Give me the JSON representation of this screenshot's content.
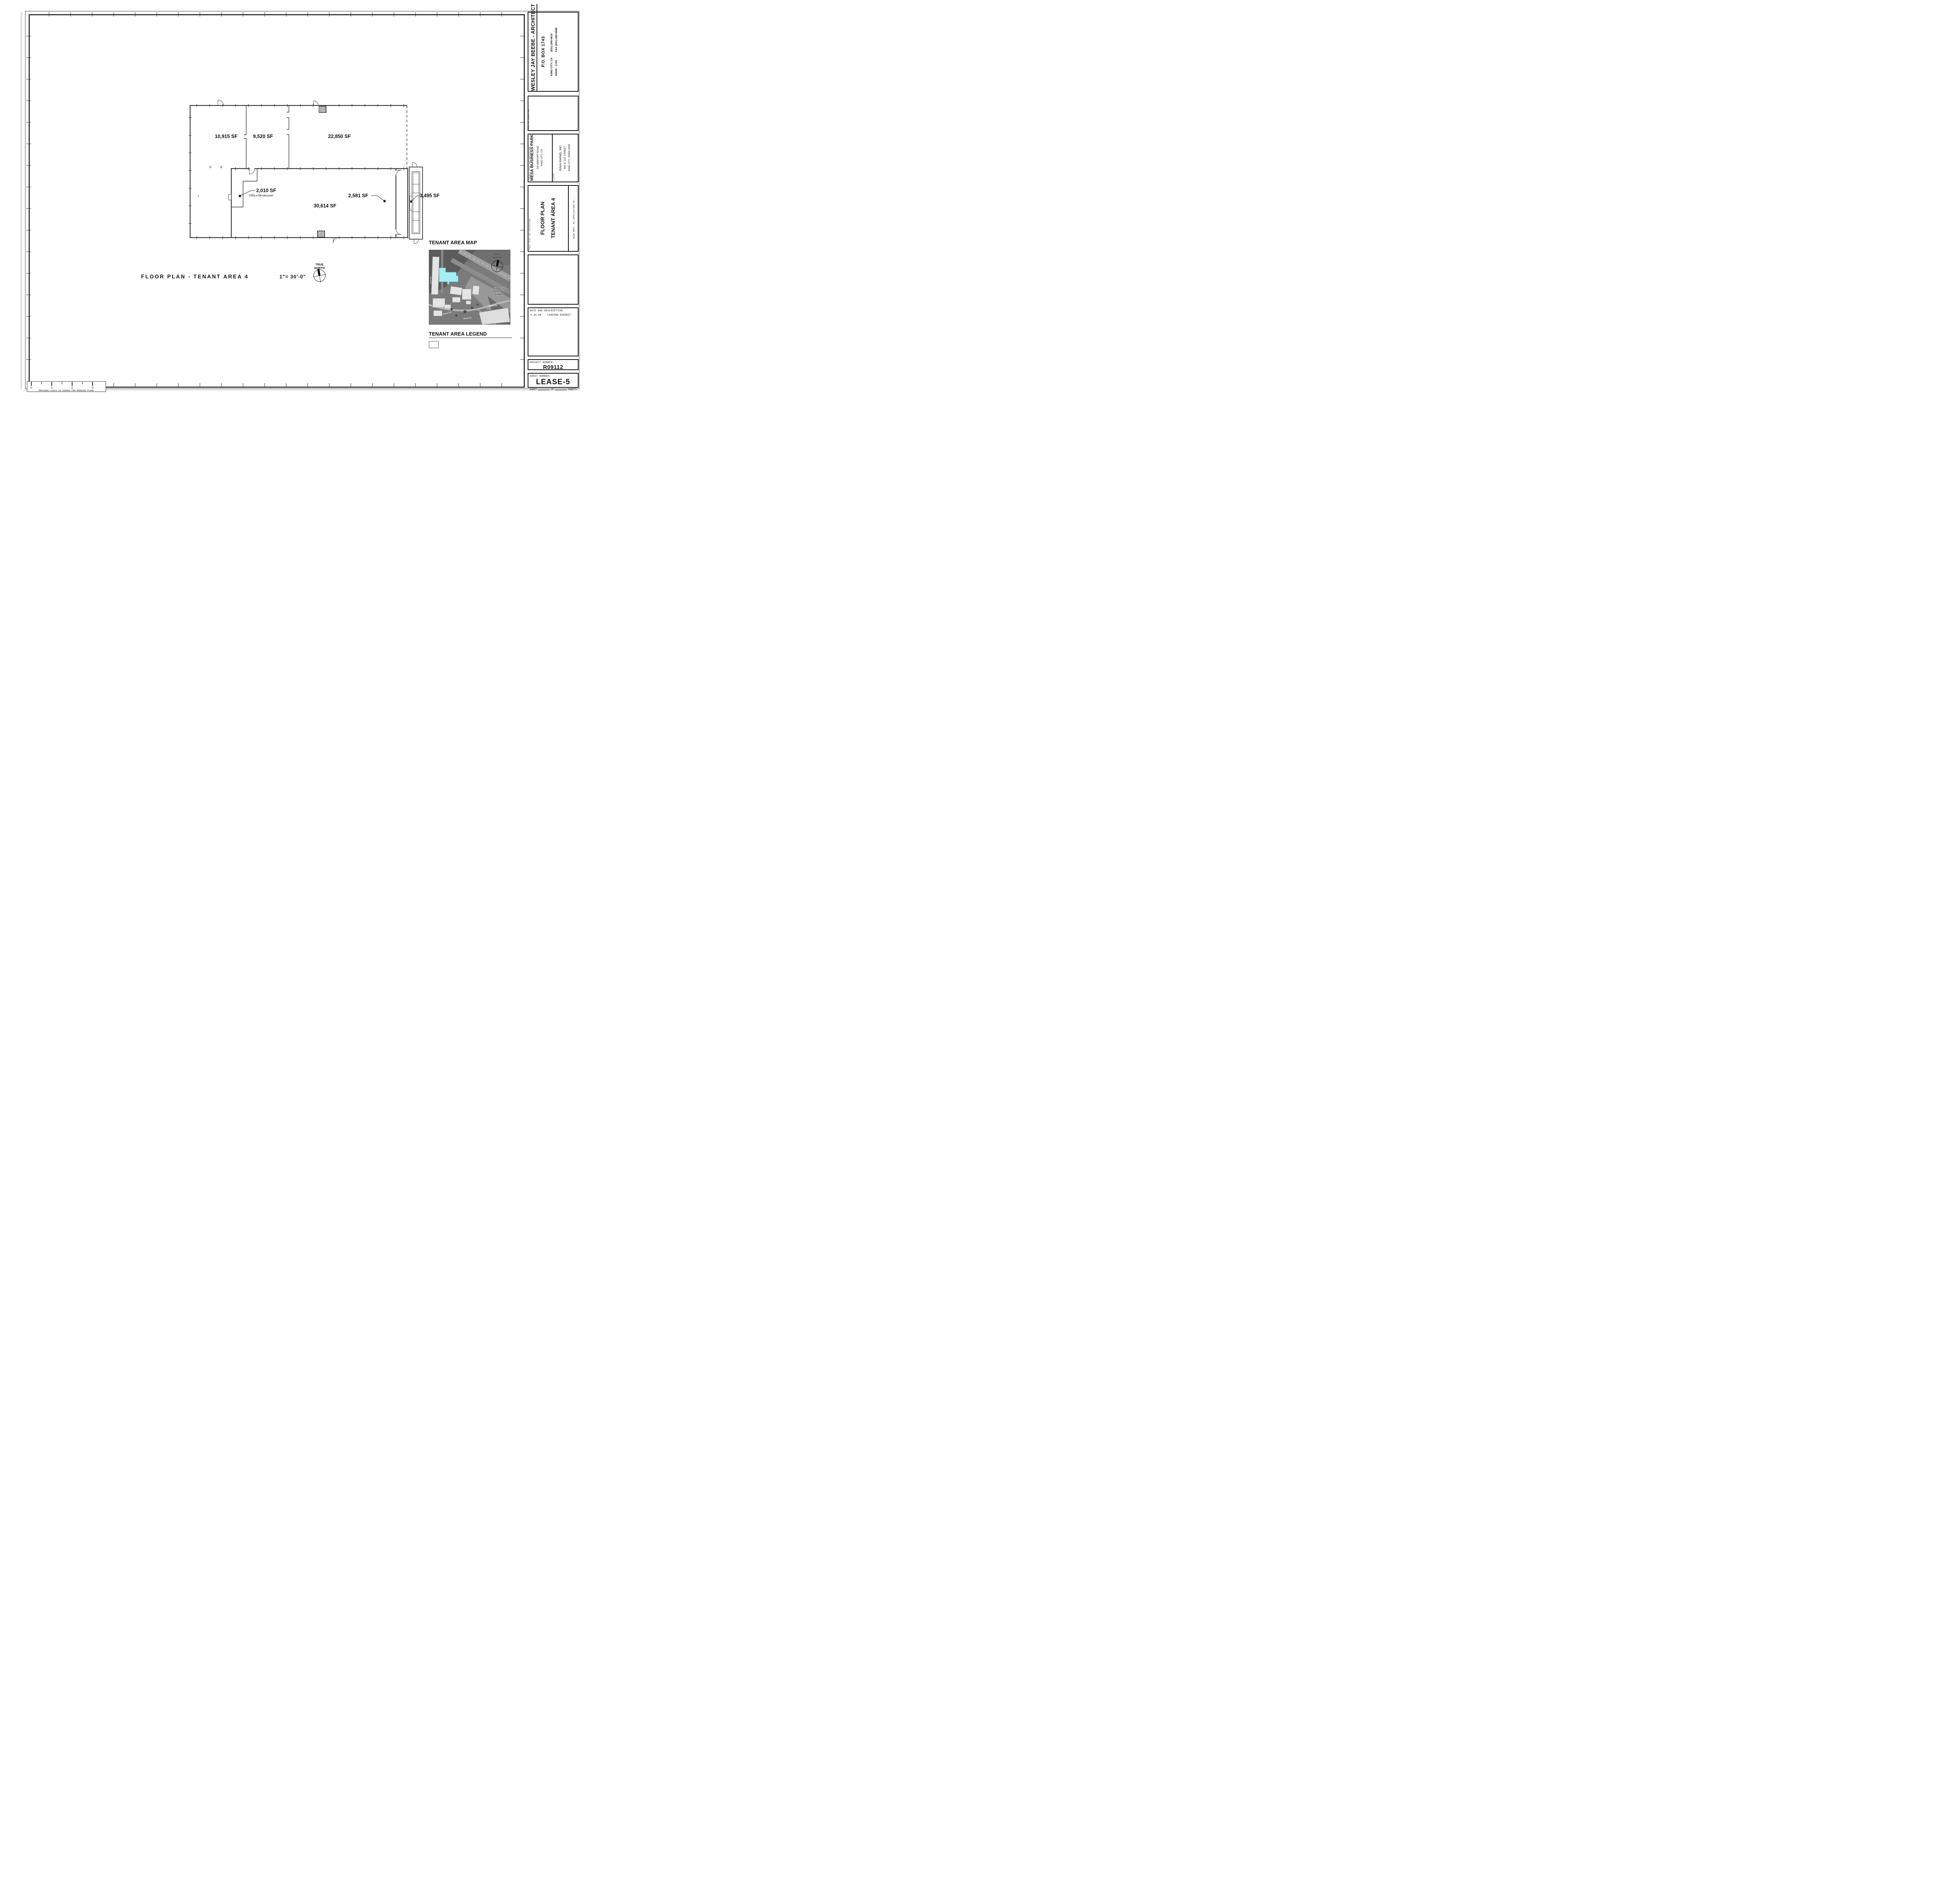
{
  "sheet_meta": {
    "architect_block": {
      "name": "WESLEY JAY BEEBE - ARCHITECT",
      "po_box": "P.O. BOX 1743",
      "city": "KING CITY, CA",
      "zip": "93930 - 1743",
      "phone": "(831)-385-0810",
      "fax": "FAX (831)-385-0688"
    },
    "seal_label": "SEAL OR CONSULTANT",
    "project_block": {
      "label": "PROJECT TITLE AND DESCRIPTION:",
      "project_name": "MESA BUSINESS PARK",
      "address1": "700 AIRPORT ROAD",
      "address2": "KING CITY, CA",
      "client_label": "CLIENT:",
      "client_name": "RAVA FARMS, INC.",
      "client_address1": "404 S. 1ST STREET",
      "client_address2": "KING CITY, 93930-2938"
    },
    "sheet_title_block": {
      "label": "SHEET TITLE AND DESCRIPTION:",
      "title_line1": "FLOOR PLAN",
      "title_line2": "TENANT AREA 4",
      "bldg_dept_label": "BLDG DEPT. No./APPLICATION No. :"
    },
    "date_block": {
      "header": "DATE AND DESCRIPTION:",
      "entries": [
        {
          "date": "4.29.09",
          "description": "LEASING EXHIBIT"
        }
      ]
    },
    "project_number_block": {
      "label": "PROJECT NUMBER:",
      "value": "R09112"
    },
    "sheet_number_block": {
      "label": "SHEET NUMBER:",
      "value": "LEASE-5",
      "footer_sheet": "SHEET",
      "footer_of": "OF",
      "footer_sheets": "SHEETS"
    }
  },
  "plan": {
    "title": "FLOOR PLAN - TENANT AREA 4",
    "scale": "1\"=  30'-0\"",
    "north_line1": "TRUE",
    "north_line2": "NORTH",
    "rooms": [
      {
        "area": "10,915 SF"
      },
      {
        "area": "9,520 SF"
      },
      {
        "area": "22,850 SF"
      },
      {
        "area": "2,010 SF",
        "sub": "Office/Breakroom"
      },
      {
        "area": "30,614 SF"
      },
      {
        "area": "2,581 SF"
      },
      {
        "area": "3,495 SF"
      }
    ]
  },
  "map": {
    "title": "TENANT AREA MAP",
    "north_line1": "TRUE",
    "north_line2": "NORTH",
    "airport_name_1": "King City",
    "airport_name_2": "Municipal",
    "airport_name_3": "Airport",
    "metz_rd": "Metz Rd",
    "airport_rd_1": "Airport Rd",
    "airport_rd_2": "Airport Rd",
    "airport_dr": "Airport Dr",
    "highlight_color": "#a5ecf3"
  },
  "legend": {
    "title": "TENANT AREA  LEGEND"
  },
  "ruler": {
    "ticks": [
      "0",
      "1",
      "2",
      "3"
    ],
    "caption": "ORIGINAL SCALE IN INCHES FOR REDUCED PLANS"
  }
}
